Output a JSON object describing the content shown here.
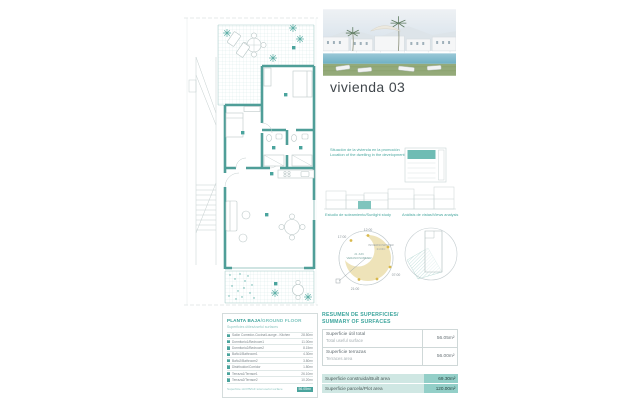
{
  "page": {
    "title": "vivienda 03"
  },
  "plan_table": {
    "title_es": "PLANTA BAJA",
    "title_en": "/GROUND FLOOR",
    "subtitle": "Superficies útiles/useful surfaces",
    "rows": [
      {
        "num": "01",
        "label": "Salón Comedor-Cocina/Lounge - Kitchen",
        "value": "28.50m²"
      },
      {
        "num": "02",
        "label": "Dormitorio1/Bedroom1",
        "value": "11.00m²"
      },
      {
        "num": "03",
        "label": "Dormitorio2/Bedroom2",
        "value": "8.15m²"
      },
      {
        "num": "04",
        "label": "Baño1/Bathroom1",
        "value": "4.30m²"
      },
      {
        "num": "05",
        "label": "Baño2/Bathroom2",
        "value": "3.80m²"
      },
      {
        "num": "06",
        "label": "Distribuidor/Corridor",
        "value": "1.80m²"
      },
      {
        "num": "07",
        "label": "Terraza1/Terrace1",
        "value": "26.10m²"
      },
      {
        "num": "08",
        "label": "Terraza2/Terrace2",
        "value": "10.20m²"
      }
    ],
    "total_label": "Superficie útil PB/GF total useful surface",
    "total_value": "56.05m²"
  },
  "captions": {
    "location_line1": "Situación de la vivienda en la promoción",
    "location_line2": "Location of the dwelling in the development",
    "sun_study": "Estudio de soleamiento/Sunlight study",
    "views_study": "Análisis de vistas/Views analysis"
  },
  "sun_diagram": {
    "label_top": "12:00",
    "label_left": "17:00",
    "label_bottom": "21:00",
    "label_right": "07:00",
    "inner_summer_1": "21 JUN",
    "inner_summer_2": "VERANO/SUMMER",
    "inner_winter_1": "INVIERNO/WINTER",
    "inner_winter_2": "21 DIC"
  },
  "summary": {
    "title_line1": "RESUMEN DE SUPERFICIES/",
    "title_line2": "SUMMARY OF SURFACES",
    "rows": [
      {
        "label_es": "Superficie útil total",
        "label_en": "Total useful surface",
        "value": "56.05m²"
      },
      {
        "label_es": "Superficie terrazas",
        "label_en": "Terraces area",
        "value": "56.00m²"
      }
    ],
    "highlight_rows": [
      {
        "label": "Superficie construida/Built area",
        "value": "69.30m²"
      },
      {
        "label": "Superficie parcela/Plot area",
        "value": "120.00m²"
      }
    ]
  },
  "colors": {
    "accent": "#45a09a",
    "wall": "#4f9e98",
    "light_teal": "#cfe7e3",
    "sun_yellow": "#eee3b9"
  }
}
